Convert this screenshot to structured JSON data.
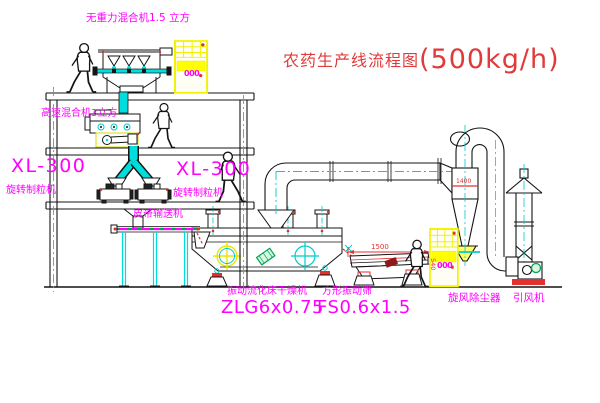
{
  "title": {
    "name": "农药生产线流程图",
    "capacity": "(500kg/h)"
  },
  "equipment": {
    "gravity_mixer_label": "无重力混合机1.5 立方",
    "high_speed_mixer_label": "高速混合机3立方",
    "granulator_left": {
      "model": "XL-300",
      "name": "旋转制粒机"
    },
    "granulator_right": {
      "model": "XL-300",
      "name": "旋转制粒机"
    },
    "belt_conveyor_label": "皮带输送机",
    "fluid_bed_dryer": {
      "name": "振动流化床干燥机",
      "model": "ZLG6x0.75"
    },
    "vibrating_screen": {
      "name": "方形振动筛",
      "model": "FS0.6x1.5"
    },
    "cyclone_label": "旋风除尘器",
    "fan_label": "引风机"
  },
  "annotations": {
    "screen_length_dim": "1500",
    "screen_height_dim": "540",
    "cyclone_dim": "1400",
    "cabinet_display_top": "000",
    "cabinet_display_right": "000"
  },
  "colors": {
    "label_magenta": "#ff00ff",
    "title_red": "#e03a3a",
    "centerline_cyan": "#00cccc",
    "cabinet_yellow": "#f2f200",
    "accent_green": "#00a550",
    "dimension_red": "#e03030",
    "line_black": "#141414"
  }
}
